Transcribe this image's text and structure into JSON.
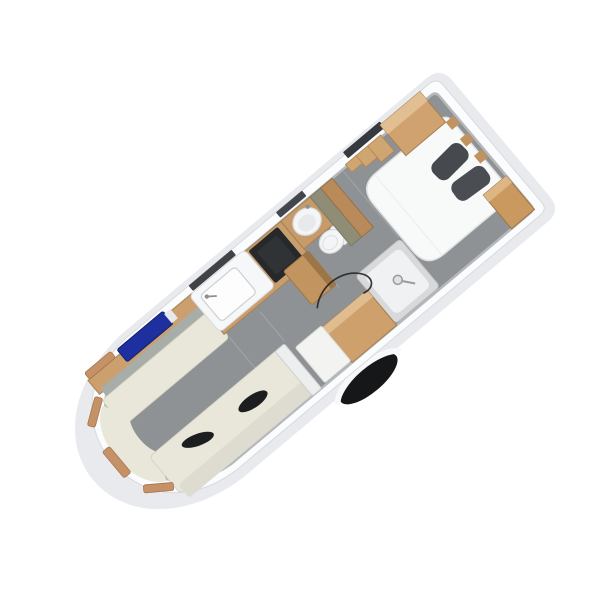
{
  "scene": {
    "description": "3D isometric cutaway floor plan of a caravan interior, rotated diagonally, nose at lower-left and rear bedroom at upper-right, on a plain white background",
    "rotation_deg": -40
  },
  "palette": {
    "body_white": "#fbfcfd",
    "body_shadow": "#e8eaed",
    "floor_gray": "#8f9295",
    "wall_base_gray": "#b6b9bc",
    "seam_gray": "#a2a5a8",
    "wood": "#c99e6e",
    "wood_dark": "#a87f52",
    "wood_light": "#e2bf92",
    "cream_cushion": "#e9e7da",
    "cream_backrest": "#dedcd0",
    "backrest_gray": "#a9ada8",
    "bolster_black": "#1b1d1f",
    "navy_blue": "#1e2f9f",
    "olive_wall": "#8f8d75",
    "cooktop_black": "#26282a",
    "bed_white": "#f8f9f9",
    "pillow_gray": "#46494d",
    "ceramic_white": "#f4f5f6",
    "shower_tray": "#f0f1f2",
    "window_tan": "#c59166",
    "tyre_black": "#151719",
    "slat_dark": "#3f4246",
    "cable_dark": "#232527",
    "partition_white": "#edeeee"
  },
  "rooms": {
    "front_lounge": {
      "items": [
        "left bench sofa with gray backrest",
        "curved front bench",
        "right bench sofa",
        "wood sideboard",
        "navy blue unit on sideboard",
        "two black bolster cushions",
        "tan front windows",
        "white end partition"
      ]
    },
    "kitchen": {
      "items": [
        "white worktop with sink and tap",
        "black cooktop",
        "wood base cabinets",
        "wood corner column"
      ]
    },
    "washroom": {
      "items": [
        "wood vanity with round white basin and tap",
        "white cassette toilet",
        "olive partition wall",
        "wood partition wall",
        "dark wall slat"
      ]
    },
    "shower_area": {
      "items": [
        "white shower tray with mixer",
        "wood bench",
        "white bench cushion",
        "dark floor cable"
      ]
    },
    "rear_bedroom": {
      "items": [
        "white island double bed",
        "two dark gray pillows",
        "rear corner wardrobe left",
        "rear corner wardrobe right",
        "stepped wood wall shelves",
        "dark window slat",
        "wood wall trims"
      ]
    },
    "exterior": {
      "items": [
        "white body shell with rounded nose cap",
        "gray shell shadow band",
        "black road wheel",
        "white wheel arch"
      ]
    }
  }
}
